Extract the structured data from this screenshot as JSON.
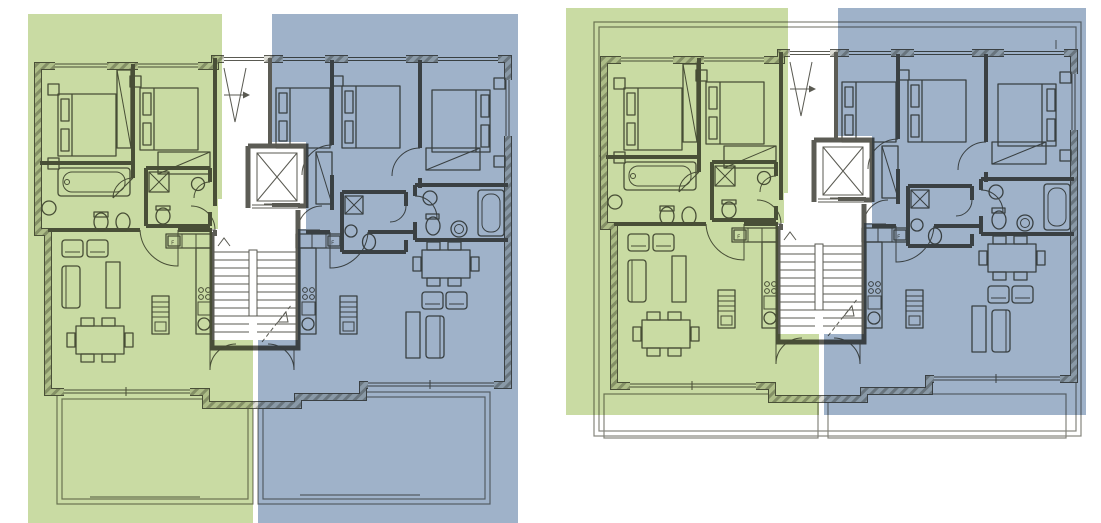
{
  "figure": {
    "title": "residential-floor-plans",
    "plans": [
      {
        "id": "plan-left",
        "variant": "ground-floor-with-garden-terraces"
      },
      {
        "id": "plan-right",
        "variant": "upper-floor-with-balcony-outline"
      }
    ],
    "units": {
      "green": {
        "name": "left-unit",
        "color": "#c9dba3"
      },
      "blue": {
        "name": "right-unit",
        "color": "#9fb2c9"
      }
    },
    "ink": {
      "wall_dark": "#5c5c55",
      "ink": "#5a5a52",
      "ink_light": "#85857d"
    },
    "fridge_label": "F"
  }
}
